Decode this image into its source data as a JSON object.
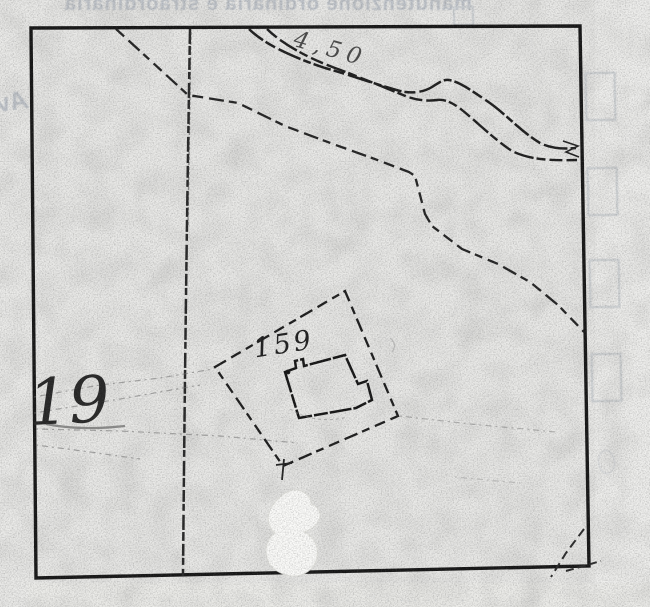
{
  "map": {
    "parcel_label": "159",
    "left_parcel_label": "19",
    "road_annotation": "4,50"
  },
  "bleed_through": {
    "top_text": "manutenzione ordinaria e straordinaria",
    "left_text": "Av",
    "bottom_text": "· ·· ˙ · ··· ·˙ · ·· ˙ ··· · ·· ˙˙ · ··· ·· ˙ · · ·· ˙ ···"
  },
  "features": {
    "frame": "map sheet border",
    "road": "double-line road (top right)",
    "boundary_path": "long dashed boundary line",
    "parcel_boundary": "dashed parcel 159 boundary",
    "building": "building footprint inside parcel 159",
    "tracks": "faint dotted field paths (left)",
    "whiteout": "correction-fluid blob (bottom)"
  },
  "colors": {
    "paper": "#e9e9e7",
    "ink": "#1c1c1c",
    "bleed": "#bfc4ca",
    "whiteout": "#fbfbf9"
  }
}
